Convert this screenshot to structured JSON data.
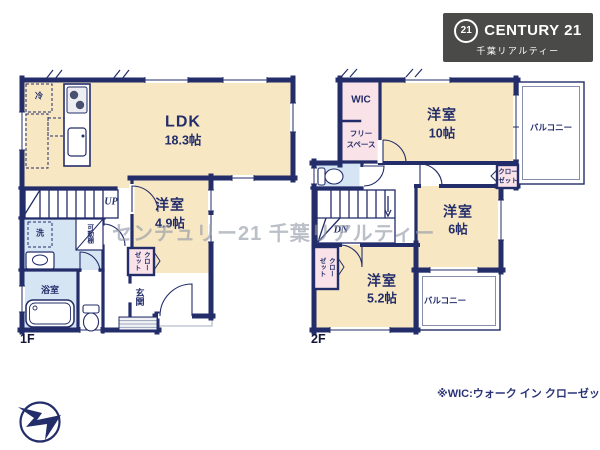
{
  "logo": {
    "mark": "21",
    "brand": "CENTURY 21",
    "subtitle": "千葉リアルティー"
  },
  "watermark": "センチュリー21 千葉リアルティー",
  "note": "※WIC:ウォーク イン クローゼット",
  "floor1": {
    "label": "1F",
    "ldk_name": "LDK",
    "ldk_size": "18.3帖",
    "bedroom_name": "洋室",
    "bedroom_size": "4.9帖",
    "bath": "浴室",
    "entrance": "玄関",
    "closet": "クローゼット",
    "shelf": "可動棚",
    "fridge": "冷",
    "washer": "洗",
    "stairs": "UP"
  },
  "floor2": {
    "label": "2F",
    "wic": "WIC",
    "free_space_line1": "フリー",
    "free_space_line2": "スペース",
    "bedroom10_name": "洋室",
    "bedroom10_size": "10帖",
    "bedroom6_name": "洋室",
    "bedroom6_size": "6帖",
    "bedroom52_name": "洋室",
    "bedroom52_size": "5.2帖",
    "balcony_right": "バルコニー",
    "balcony_bottom": "バルコニー",
    "closet_right_line1": "クロー",
    "closet_right_line2": "ゼット",
    "closet_left": "クローゼット",
    "stairs": "DN"
  },
  "colors": {
    "wall": "#232d6a",
    "room_beige": "#f7e7c3",
    "closet_pink": "#f9e2e8",
    "wet_blue": "#d6e5f3",
    "logo_bg": "#4a4a48",
    "note_text": "#2a3376"
  }
}
